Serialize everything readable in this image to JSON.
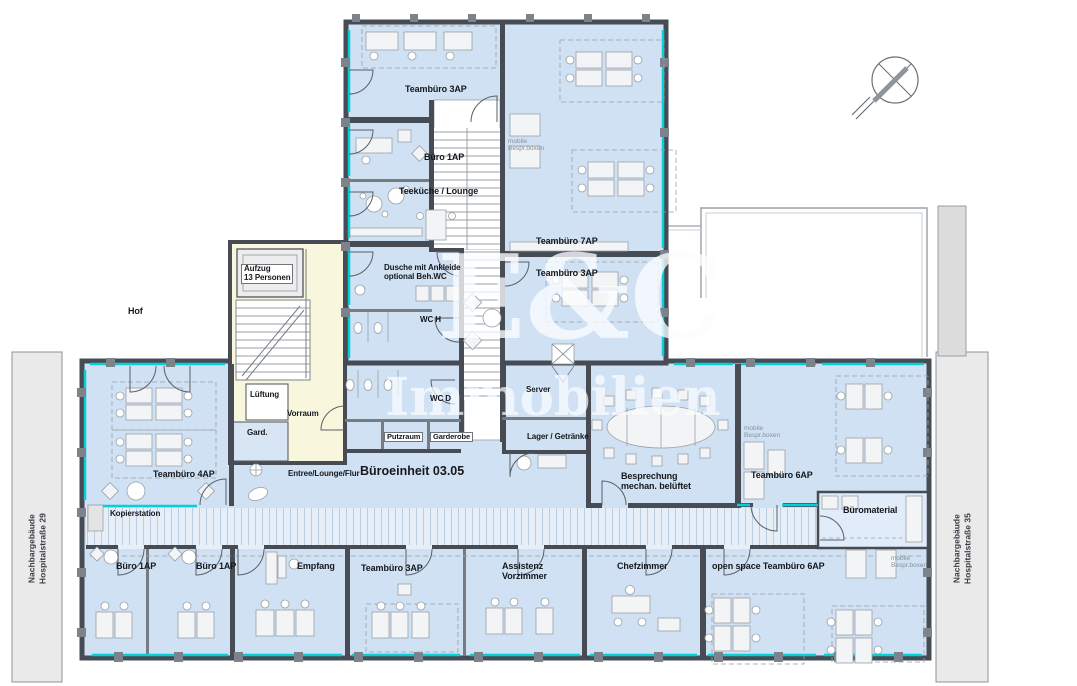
{
  "plan": {
    "unit_title": "Büroeinheit 03.05",
    "colors": {
      "room_fill": "#cfe1f3",
      "corridor_fill": "#e6eef8",
      "wall": "#474c54",
      "glazing_accent": "#06cfd8",
      "stairwell_fill": "#f8f7dd",
      "neighbor_fill": "#eaeaea",
      "furniture_stroke": "#9aa0a6"
    },
    "watermark": {
      "line1": "E&C",
      "line2": "Immobilien"
    }
  },
  "labels": {
    "teambuero_3ap_top": "Teambüro 3AP",
    "buero_1ap_top": "Büro 1AP",
    "teekueche": "Teeküche / Lounge",
    "mobile_boxen_top": "mobile\nBespr.boxen",
    "teambuero_7ap": "Teambüro 7AP",
    "teambuero_3ap_mid": "Teambüro 3AP",
    "aufzug": "Aufzug\n13 Personen",
    "hof": "Hof",
    "dusche": "Dusche mit Ankleide\noptional Beh.WC",
    "wc_h": "WC H",
    "wc_d": "WC D",
    "server": "Server",
    "lager": "Lager / Getränke",
    "putzraum": "Putzraum",
    "garderobe": "Garderobe",
    "lueftung": "Lüftung",
    "vorraum": "Vorraum",
    "gard": "Gard.",
    "teambuero_4ap": "Teambüro 4AP",
    "kopierstation": "Kopierstation",
    "entree": "Entree/Lounge/Flur",
    "einheit": "Büroeinheit 03.05",
    "besprechung": "Besprechung\nmechan. belüftet",
    "teambuero_6ap": "Teambüro 6AP",
    "mobile_boxen_mid": "mobile\nBespr.boxen",
    "bueromaterial": "Büromaterial",
    "buero_1ap_b1": "Büro 1AP",
    "buero_1ap_b2": "Büro 1AP",
    "empfang": "Empfang",
    "teambuero_3ap_bottom": "Teambüro 3AP",
    "assistenz": "Assistenz\nVorzimmer",
    "chefzimmer": "Chefzimmer",
    "openspace": "open space Teambüro 6AP",
    "mobile_boxen_bottom": "mobile\nBespr.boxen",
    "nachbar_links": "Nachbargebäude\nHospitalstraße 29",
    "nachbar_rechts": "Nachbargebäude\nHospitalstraße 35"
  }
}
